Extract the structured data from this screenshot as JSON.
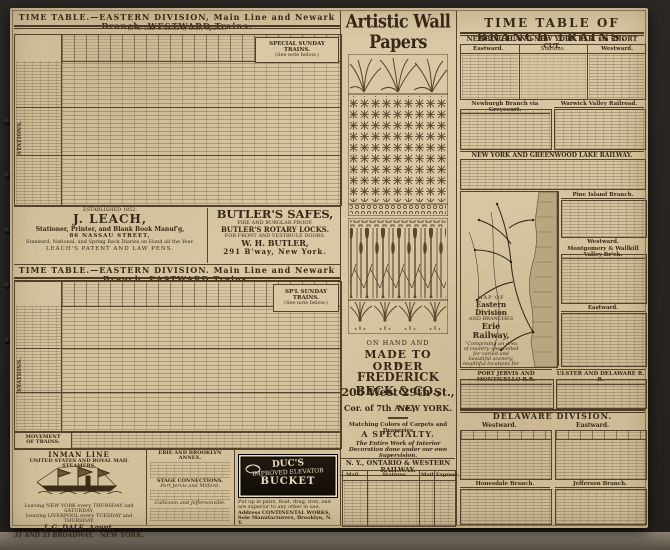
{
  "left": {
    "stations_label": "STATIONS.",
    "westward": {
      "title": "TIME TABLE.—EASTERN DIVISION,  Main Line and Newark Branch.  WESTWARD Trains.",
      "note": "(P. M. Time is shown by heavy figures.)",
      "special": "SPECIAL SUNDAY TRAINS.",
      "special_note": "(See note below.)"
    },
    "eastward": {
      "title": "TIME TABLE.—EASTERN DIVISION.  Main Line and Newark Branch.  EASTWARD Trains.",
      "special": "SP'L SUNDAY TRAINS.",
      "special_note": "(See note below.)",
      "movement1": "MOVEMENT",
      "movement2": "OF TRAINS."
    }
  },
  "ads": {
    "leach": {
      "est": "ESTABLISHED 1852.",
      "name": "J. LEACH,",
      "line1": "Stationer, Printer, and Blank Book Manuf'g,",
      "line2": "86 NASSAU STREET,",
      "line3": "Standard, National, and Spring Back Diaries on Hand all the Year.",
      "line4": "LEACH'S PATENT AND LAW PENS."
    },
    "butler": {
      "title": "BUTLER'S SAFES,",
      "sub1": "FIRE AND BURGLAR PROOF.",
      "sub2": "BUTLER'S ROTARY LOCKS.",
      "sub3": "FOR FRONT AND VESTIBULE DOORS.",
      "name": "W. H. BUTLER,",
      "addr": "291 B'way, New York."
    },
    "inman": {
      "title": "INMAN LINE",
      "sub": "UNITED STATES AND ROYAL MAIL STEAMERS.",
      "sched1": "Leaving NEW YORK every THURSDAY and SATURDAY,",
      "sched2": "Leaving LIVERPOOL every TUESDAY and THURSDAY.",
      "agent": "J. G. DALE, Agent,",
      "addr": "31 AND 33 BROADWAY,",
      "city": "NEW YORK."
    },
    "annex": {
      "title": "ERIE AND BROOKLYN ANNEX.",
      "stage": "STAGE CONNECTIONS.",
      "s1": "Port Jervis and Milford.",
      "s2": "Callicoon and Jeffersonville."
    },
    "duc": {
      "l1": "DUC'S",
      "l2": "IMPROVED ELEVATOR",
      "l3": "BUCKET",
      "note1": "Put up in pairs, float, drag, iron, and are superior to any other in use.",
      "note2": "Address CONTINENTAL WORKS, Sole Manufacturers, Brooklyn, N. Y."
    },
    "beck": {
      "headline": "Artistic Wall Papers",
      "onhand": "ON HAND AND",
      "made": "MADE TO ORDER",
      "by": "BY",
      "firm": "FREDERICK BECK & CO.,",
      "addr1": "206 West 29th St.,",
      "addr2": "Cor. of 7th Ave.,",
      "addr2b": "NEW YORK.",
      "match1": "Matching Colors of Carpets and Draperies",
      "match2": "A SPECIALTY.",
      "note": "The Entire Work of Interior Decoration done under our own Supervision."
    }
  },
  "ontario": {
    "title": "N. Y., ONTARIO & WESTERN RAILWAY.",
    "col_mail": "Mail.",
    "col_stations": "Stations.",
    "col_mail2": "Mail.",
    "col_express": "Express."
  },
  "right": {
    "big_title": "TIME TABLE OF BRANCH TRAINS.",
    "shortcut": "NEWBURGH AND NEW YORK R. R. via SHORT CUT.",
    "eastward": "Eastward.",
    "stations": "Stations.",
    "westward": "Westward.",
    "greycourt": "Newburgh Branch via Greycourt.",
    "warwick": "Warwick Valley Railroad.",
    "greenwood": "NEW YORK AND GREENWOOD LAKE RAILWAY.",
    "pine": "Pine Island Branch.",
    "mont_dir": "Westward.",
    "montgomery": "Montgomery & Wallkill Valley Br'ch.",
    "east2": "Eastward.",
    "map": {
      "l1": "MAP OF",
      "l2": "Eastern Division",
      "l3": "AND BRANCHES",
      "l4": "Erie Railway,",
      "caption": "“Comprising an area of country unexcelled for varied and beautiful scenery, healthful locations for suburban residences, and for the picturesque Summer Resorts.”"
    },
    "port_jervis": "PORT JERVIS AND MONTICELLO R.R.",
    "ulster": "ULSTER AND DELAWARE R. R.",
    "delaware": "DELAWARE DIVISION.",
    "del_west": "Westward.",
    "del_east": "Eastward.",
    "honesdale": "Honesdale Branch.",
    "jefferson": "Jefferson Branch."
  }
}
